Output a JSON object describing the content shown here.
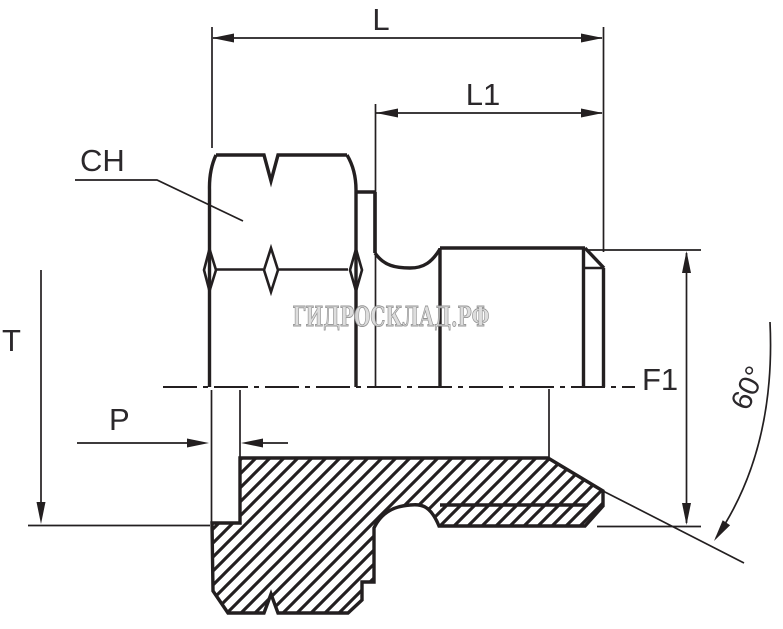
{
  "drawing": {
    "title_hint": "sectioned male stud fitting drawing",
    "watermark": "ГИДРОСКЛАД.РФ",
    "colors": {
      "background": "#ffffff",
      "line": "#231f20",
      "label": "#2b282b",
      "watermark_fill": "#dcdcdc",
      "watermark_stroke": "#8f8f8f"
    },
    "dimensions": {
      "overall_length": {
        "label": "L"
      },
      "thread_length": {
        "label": "L1"
      },
      "hex_size": {
        "label": "CH"
      },
      "tube_thread": {
        "label": "T"
      },
      "depth": {
        "label": "P"
      },
      "thread_diameter": {
        "label": "F1"
      },
      "cone_angle": {
        "label": "60°"
      }
    }
  }
}
